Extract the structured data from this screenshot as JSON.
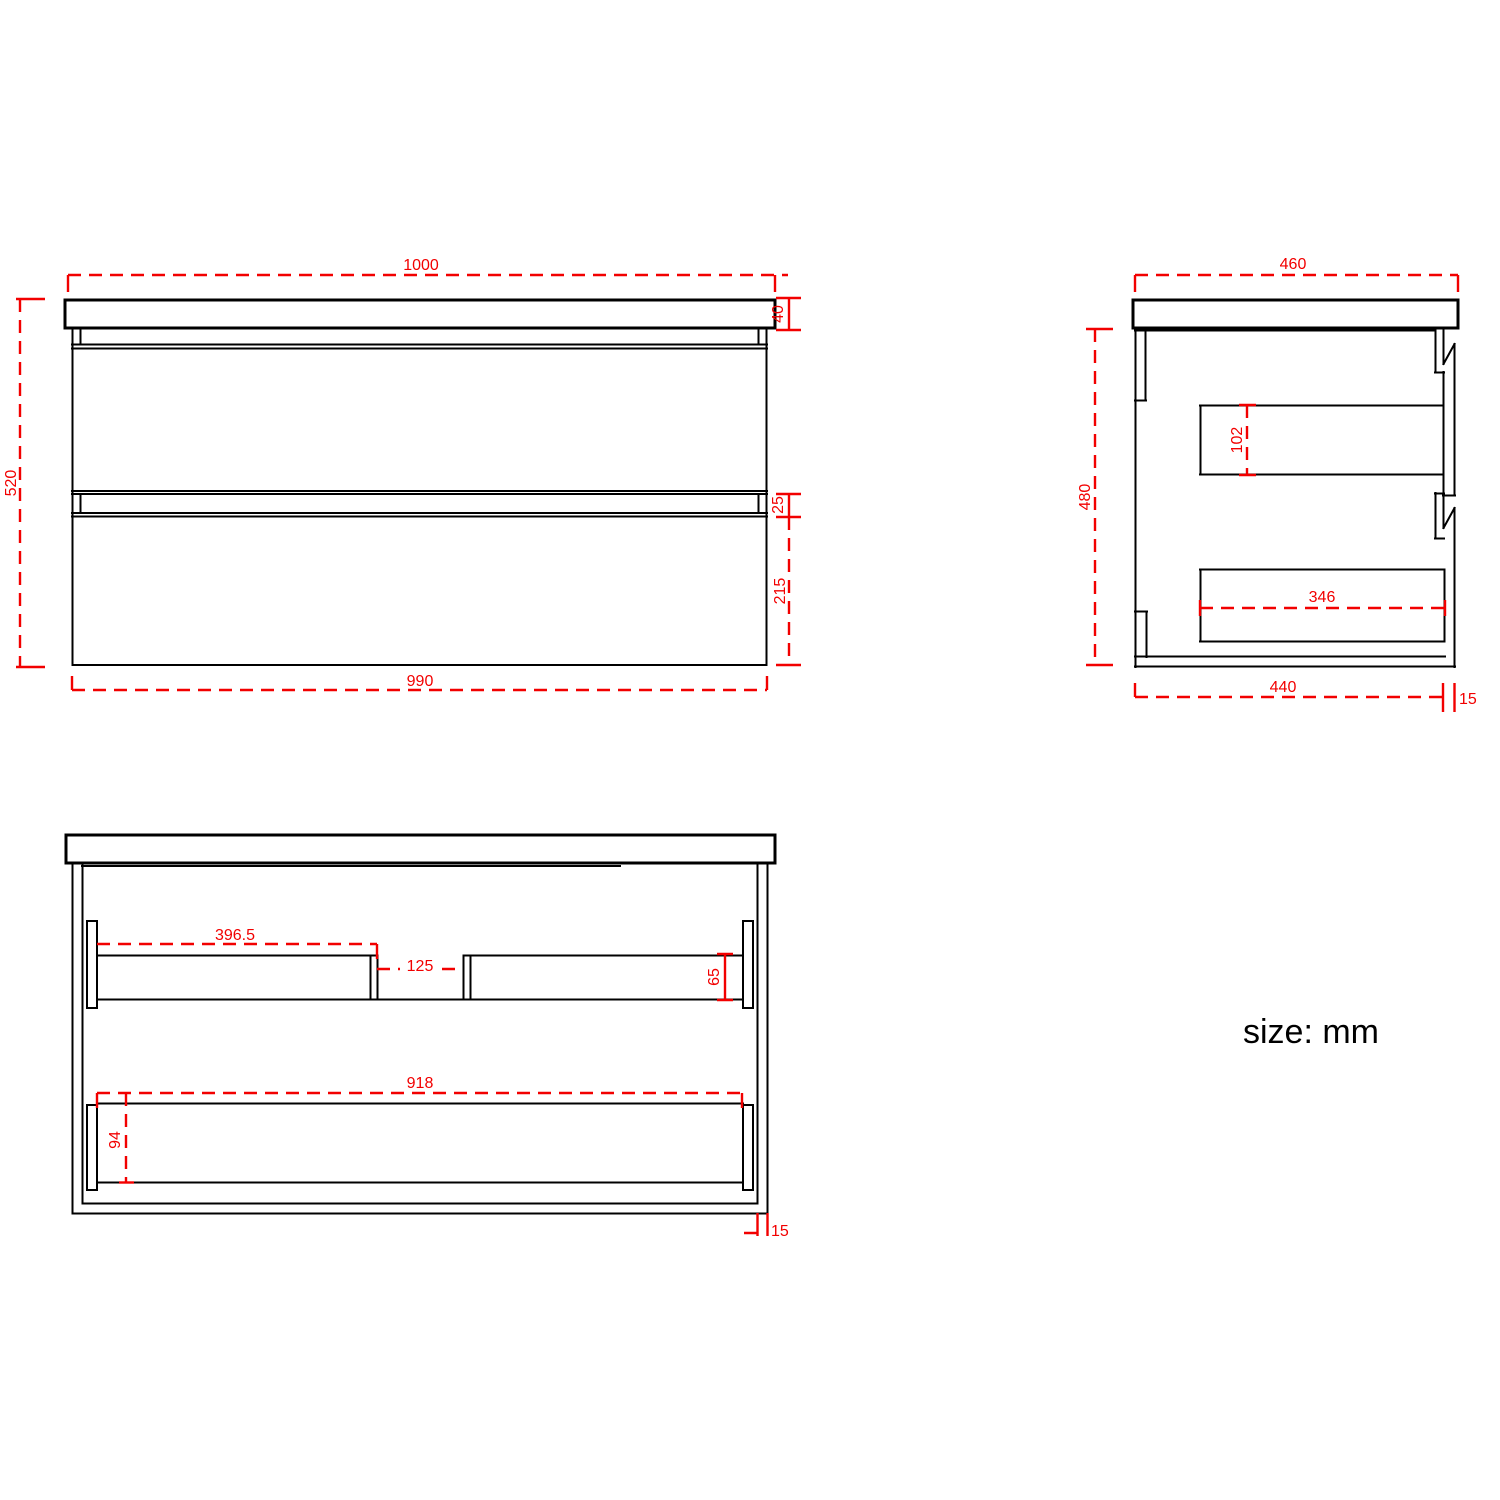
{
  "units_label": "size: mm",
  "colors": {
    "dimension": "#f20000",
    "outline": "#000000",
    "background": "#ffffff"
  },
  "views": {
    "front": {
      "label": "front view",
      "dims": {
        "overall_width": "1000",
        "overall_height": "520",
        "countertop_thickness": "40",
        "drawer_gap": "25",
        "lower_drawer_height": "215",
        "cabinet_width": "990"
      }
    },
    "side": {
      "label": "side view",
      "dims": {
        "overall_depth": "460",
        "cabinet_height": "480",
        "upper_drawer_back_height": "102",
        "lower_drawer_depth": "346",
        "cabinet_depth": "440",
        "back_panel_gap": "15"
      }
    },
    "internal": {
      "label": "internal front view",
      "dims": {
        "upper_left_drawer_width": "396.5",
        "center_gap": "125",
        "upper_rail_height": "65",
        "lower_drawer_width": "918",
        "lower_rail_height": "94",
        "side_panel_thickness": "15"
      }
    }
  }
}
